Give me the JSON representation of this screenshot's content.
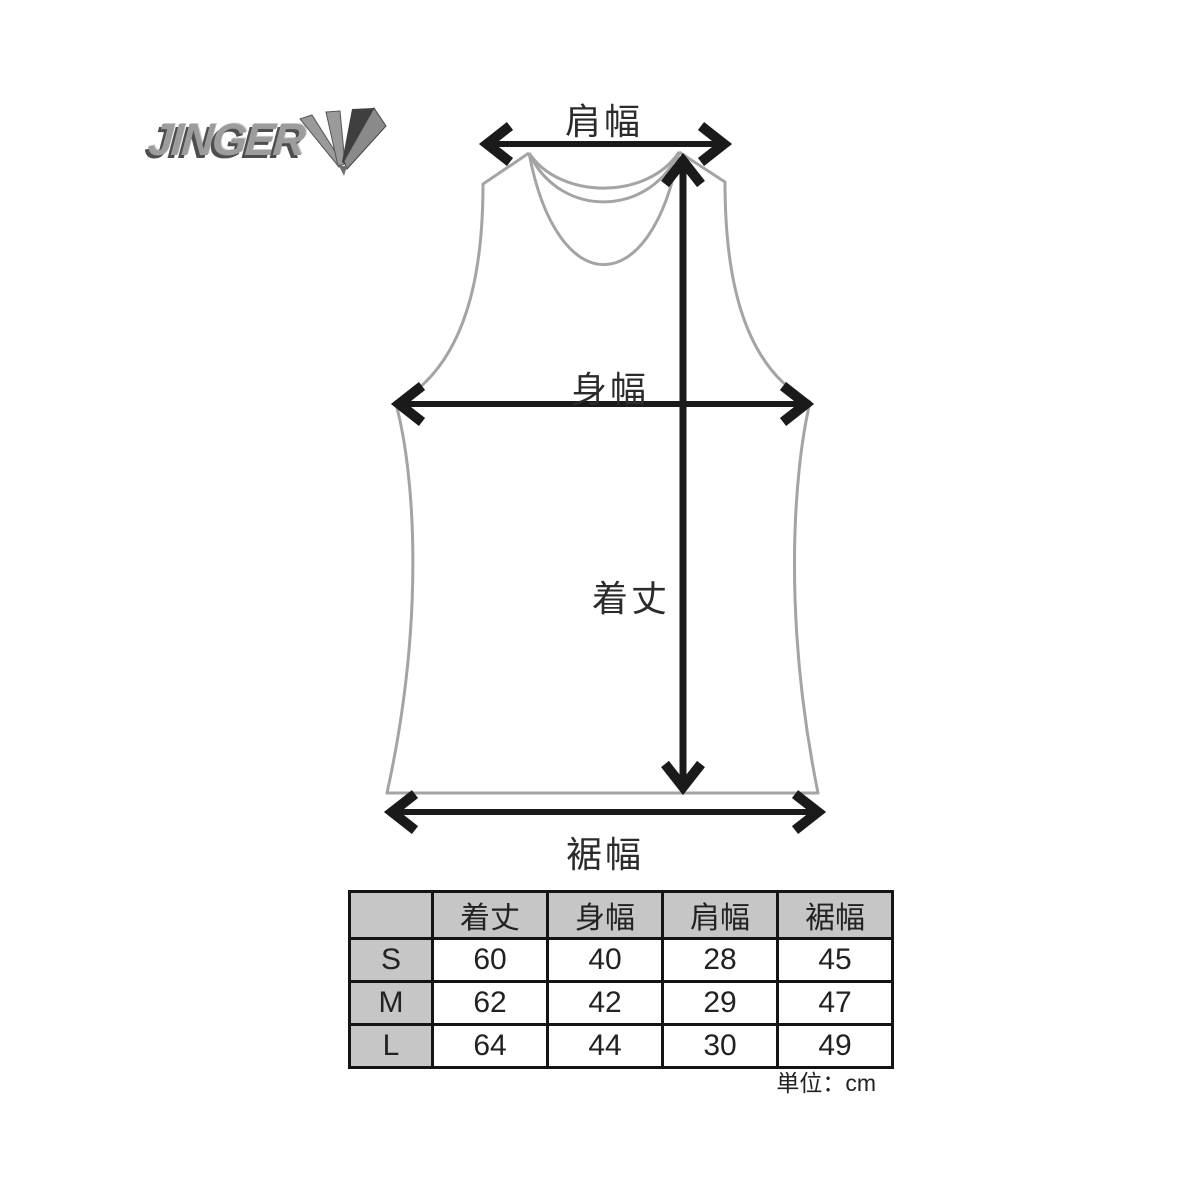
{
  "logo": {
    "brand": "JINGER",
    "mark": "triple-v-mark"
  },
  "diagram": {
    "labels": {
      "shoulder_width": "肩幅",
      "body_width": "身幅",
      "length": "着丈",
      "hem_width": "裾幅"
    },
    "colors": {
      "garment_outline": "#a4a4a4",
      "arrow": "#1a1a1a"
    }
  },
  "size_table": {
    "corner": "",
    "headers": [
      "着丈",
      "身幅",
      "肩幅",
      "裾幅"
    ],
    "rows": [
      {
        "size": "S",
        "values": [
          "60",
          "40",
          "28",
          "45"
        ]
      },
      {
        "size": "M",
        "values": [
          "62",
          "42",
          "29",
          "47"
        ]
      },
      {
        "size": "L",
        "values": [
          "64",
          "44",
          "30",
          "49"
        ]
      }
    ],
    "unit_note": "単位：cm",
    "header_bg": "#c6c6c6"
  }
}
